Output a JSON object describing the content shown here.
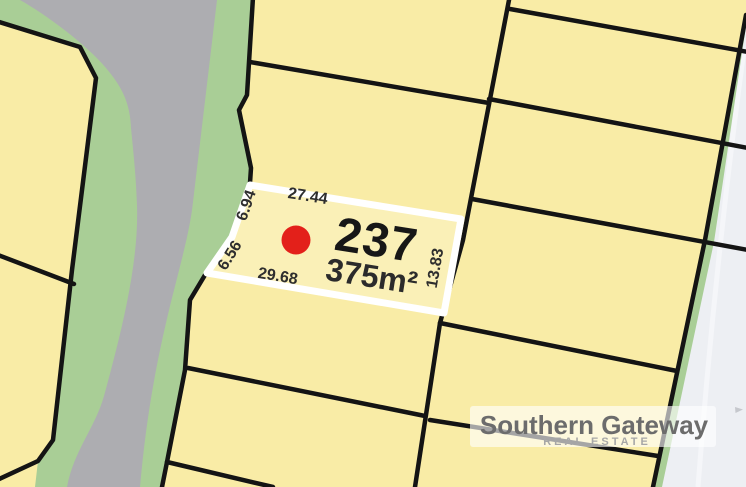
{
  "map": {
    "highlighted_lot": {
      "number": "237",
      "area": "375m²",
      "dim_top": "27.44",
      "dim_left_upper": "6.94",
      "dim_left_lower": "6.56",
      "dim_bottom": "29.68",
      "dim_right": "13.83"
    }
  },
  "branding": {
    "name": "Southern Gateway",
    "tagline": "REAL ESTATE"
  },
  "colors": {
    "background": "#EDEFF3",
    "verge_green": "#A9CE96",
    "road_gray": "#ADADB1",
    "lot_fill": "#F9ECA6",
    "highlight_fill": "#FAF0B7",
    "highlight_border": "#FFFFFF",
    "boundary_black": "#141414",
    "marker_red": "#E3201A",
    "brand_gray": "#6C6C6C",
    "tagline_gray": "#A7A7A7"
  }
}
